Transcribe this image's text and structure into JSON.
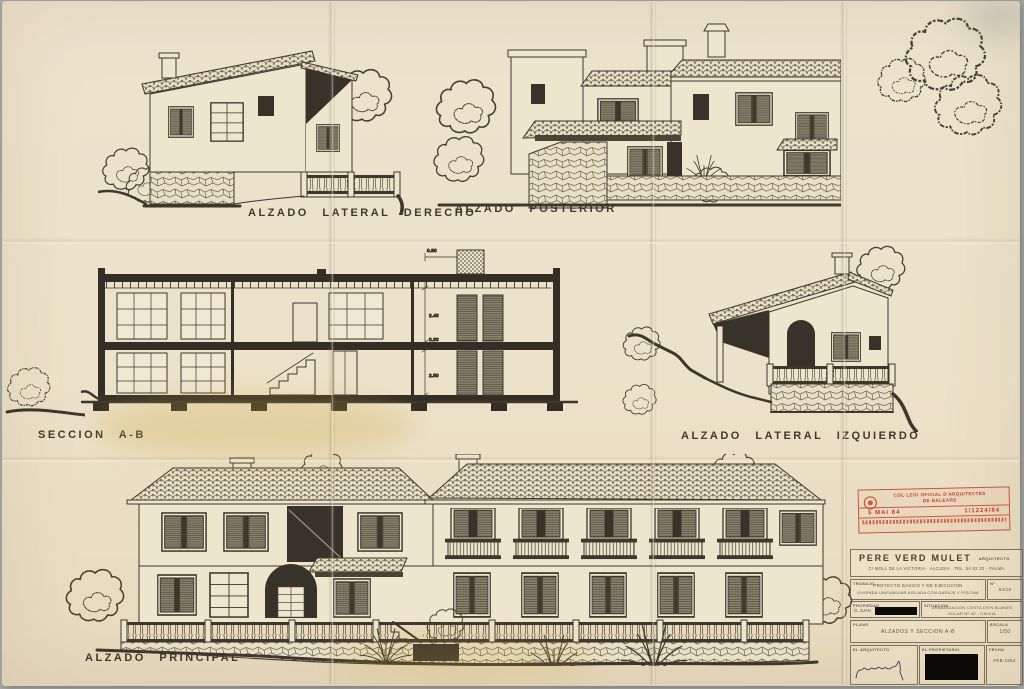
{
  "sheet": {
    "paper_color": "#ece2c9",
    "ink_color": "#3d372c",
    "stamp_red": "#c23c2b"
  },
  "labels": {
    "lateral_derecho": "ALZADO LATERAL DERECHO",
    "posterior": "ALZADO POSTERIOR",
    "seccion": "SECCION A-B",
    "lateral_izquierdo": "ALZADO LATERAL IZQUIERDO",
    "principal": "ALZADO PRINCIPAL"
  },
  "seccion_dims": {
    "top": "0.90",
    "upper": "2.40",
    "slab": "0.30",
    "lower": "2.50"
  },
  "stamp": {
    "org_line1": "COL·LEGI OFICIAL D'ARQUITECTES",
    "org_line2": "DE BALEARS",
    "date": "5 MAI 84",
    "registry": "1/1224/84"
  },
  "title_block": {
    "architect_name": "PERE VERD MULET",
    "architect_title": "ARQUITECTO",
    "address": "C/ MOLL DE LA VICTORIA · ALCUDIA · TEL. 54 62 32 · PALMA",
    "trabajo_label": "TRABAJO",
    "trabajo_line1": "PROYECTO BASICO Y DE EJECUCION",
    "trabajo_line2": "VIVIENDA UNIFAMILIAR AISLADA CON GARAJE Y PISCINA",
    "num_label": "Nº",
    "num_value": "84/18",
    "propiedad_label": "PROPIEDAD",
    "propiedad_value": "D. JUAN",
    "situacion_label": "SITUACION",
    "situacion_line1": "URBANIZACION COSTA D'EN BLANES",
    "situacion_line2": "SOLAR Nº 42 · CALVIA",
    "plano_label": "PLANO",
    "plano_value": "ALZADOS Y SECCION A-B",
    "escala_label": "ESCALA",
    "escala_value": "1/50",
    "arquitecto_label": "EL ARQUITECTO",
    "propietario_label": "EL PROPIETARIO",
    "fecha_label": "FECHA",
    "fecha_value": "FEB-1984"
  }
}
